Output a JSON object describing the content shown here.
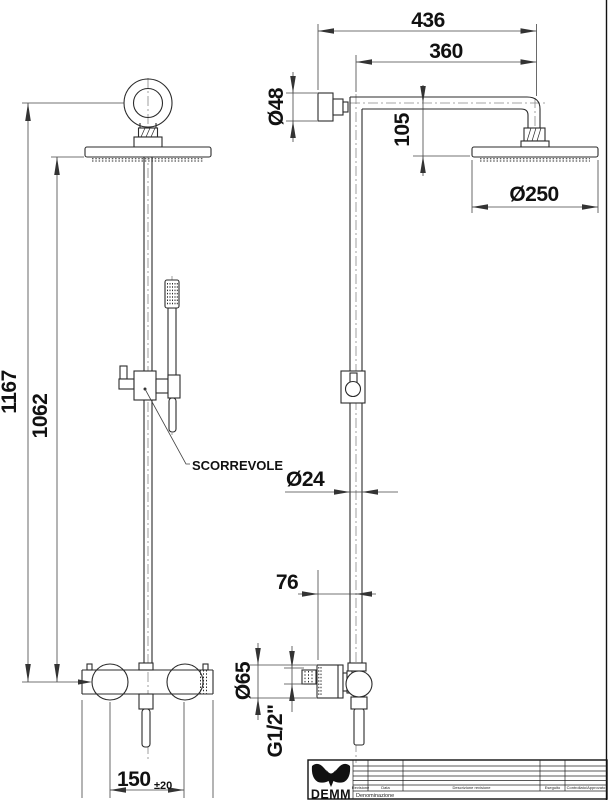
{
  "drawing": {
    "dims": {
      "total_height": "1167",
      "column_height": "1062",
      "inlet_spacing": "150",
      "inlet_tolerance": "±20",
      "arm_reach_total": "436",
      "arm_reach": "360",
      "head_drop": "105",
      "flange_diameter": "Ø48",
      "head_diameter": "Ø250",
      "pipe_diameter": "Ø24",
      "wall_offset": "76",
      "mixer_diameter": "Ø65",
      "thread": "G1/2\""
    },
    "labels": {
      "slider": "SCORREVOLE"
    },
    "title_block": {
      "brand": "DEMM",
      "denomination": "Denominazione",
      "columns": [
        "Revisione",
        "Data",
        "Descrizione revisione",
        "Eseguito",
        "Controllato/Approvato"
      ]
    }
  }
}
